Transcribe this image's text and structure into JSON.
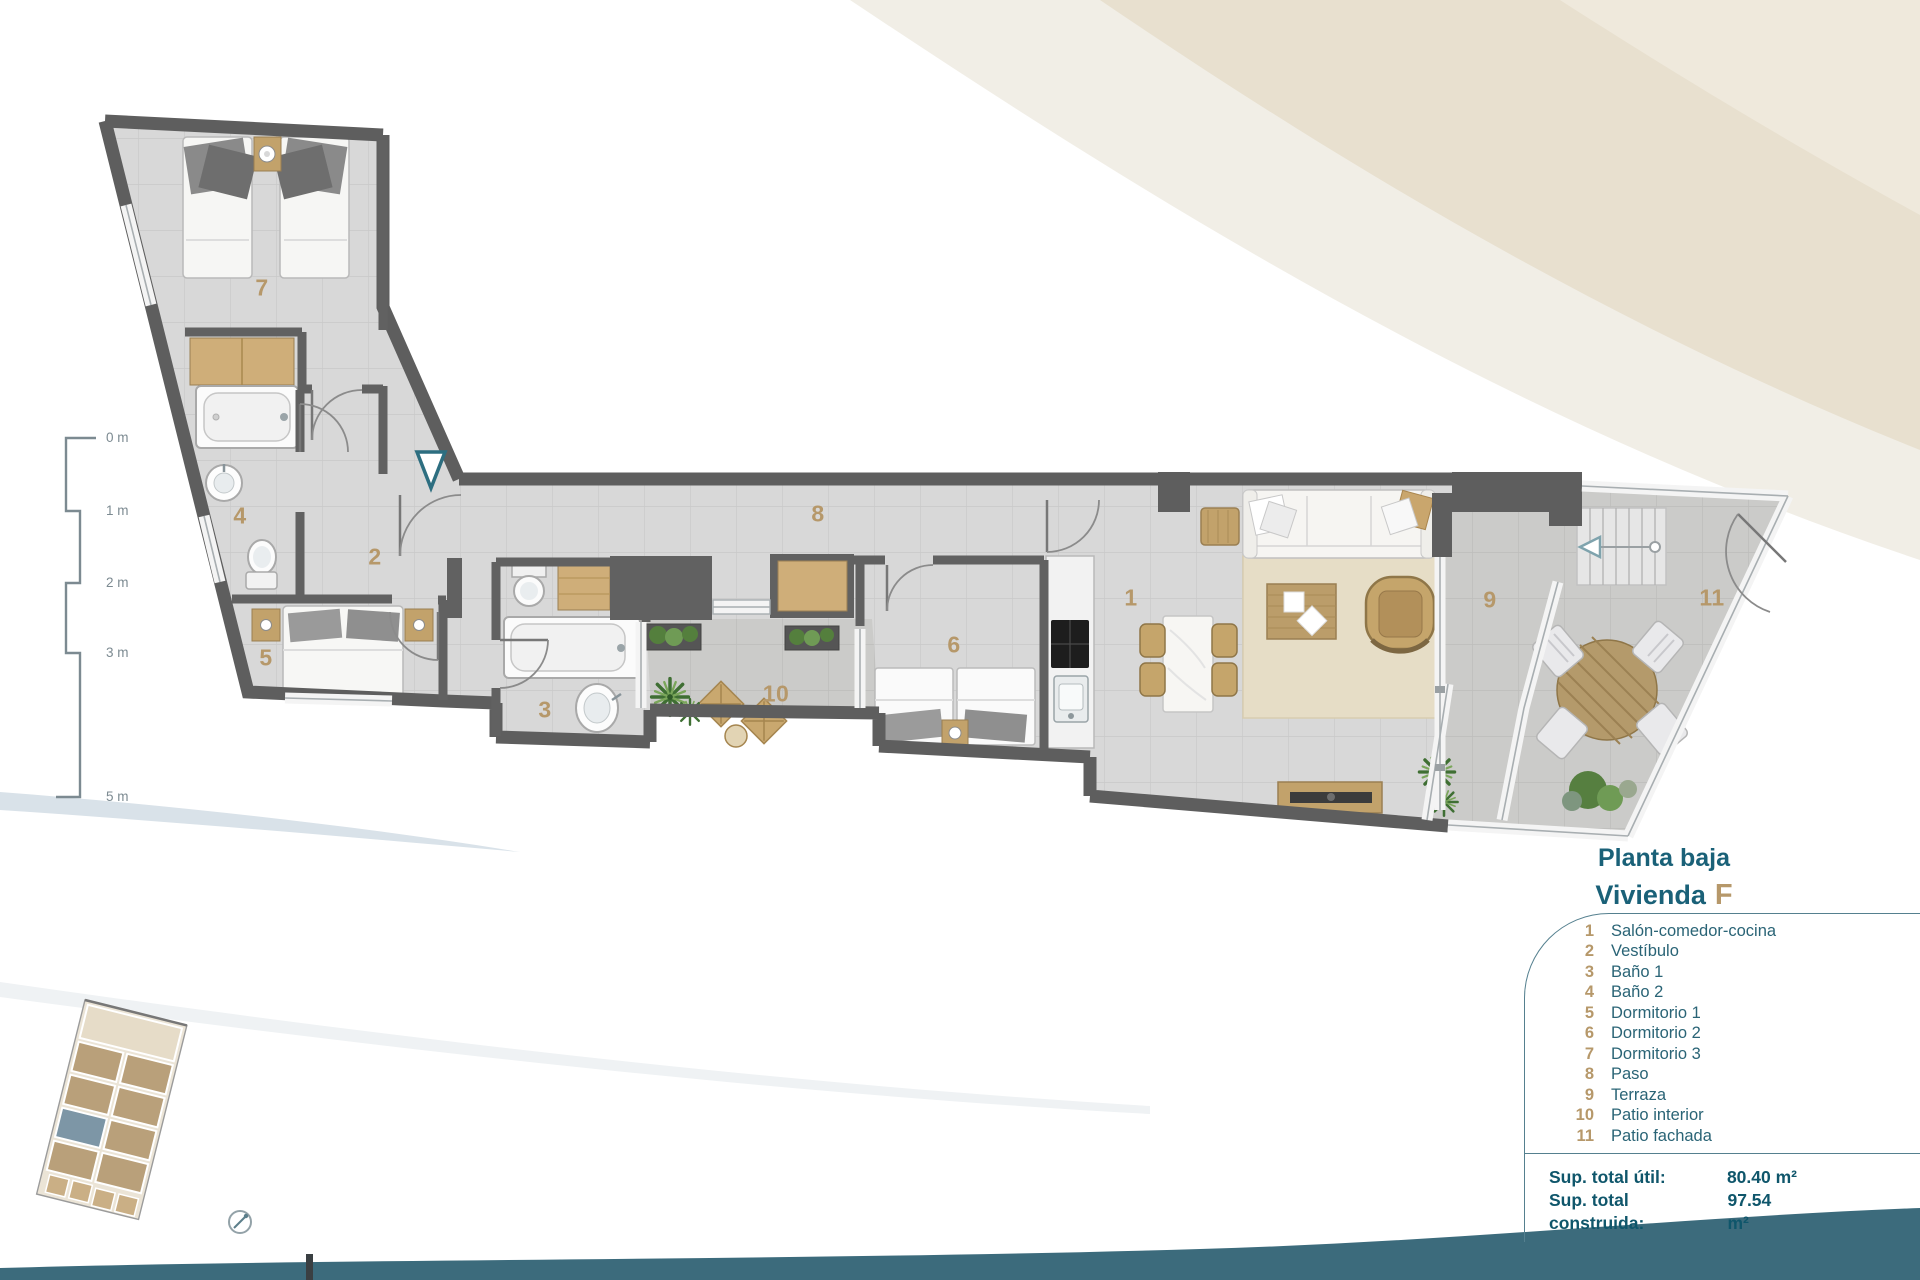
{
  "title": {
    "line1": "Planta baja",
    "line2_prefix": "Vivienda",
    "line2_unit": "F"
  },
  "legend": {
    "rooms": [
      {
        "number": "1",
        "label": "Salón-comedor-cocina"
      },
      {
        "number": "2",
        "label": "Vestíbulo"
      },
      {
        "number": "3",
        "label": "Baño 1"
      },
      {
        "number": "4",
        "label": "Baño 2"
      },
      {
        "number": "5",
        "label": "Dormitorio 1"
      },
      {
        "number": "6",
        "label": "Dormitorio 2"
      },
      {
        "number": "7",
        "label": "Dormitorio 3"
      },
      {
        "number": "8",
        "label": "Paso"
      },
      {
        "number": "9",
        "label": "Terraza"
      },
      {
        "number": "10",
        "label": "Patio interior"
      },
      {
        "number": "11",
        "label": "Patio fachada"
      }
    ]
  },
  "totals": {
    "util_label": "Sup. total útil:",
    "util_value": "80.40 m²",
    "built_label": "Sup. total construida:",
    "built_value": "97.54 m²"
  },
  "scalebar": {
    "labels": [
      "0 m",
      "1 m",
      "2 m",
      "3 m",
      "5 m"
    ]
  },
  "colors": {
    "accent_teal": "#2d6e80",
    "label_tan": "#b6986a",
    "wave": "#3c6b7c",
    "beige": "#e8e0cf"
  }
}
